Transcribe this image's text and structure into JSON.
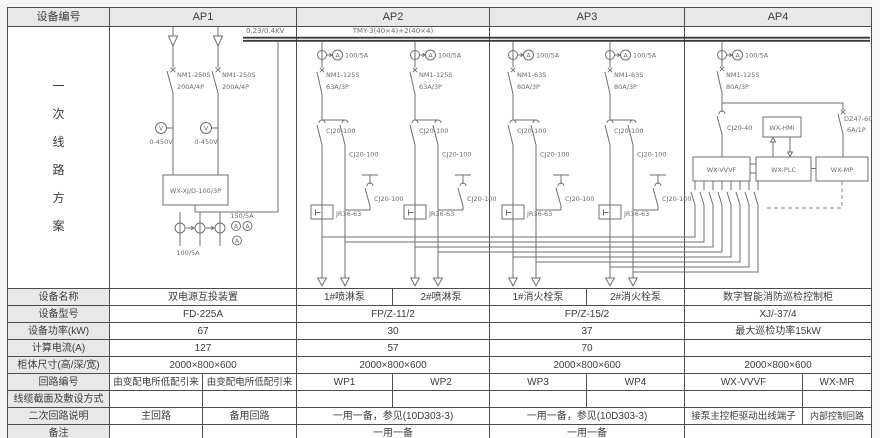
{
  "header": {
    "device_no_label": "设备编号",
    "panels": [
      "AP1",
      "AP2",
      "AP3",
      "AP4"
    ]
  },
  "side": {
    "chars": [
      "一",
      "次",
      "线",
      "路",
      "方",
      "案"
    ]
  },
  "diagram": {
    "busbar_voltage": "0.23/0.4KV",
    "busbar_spec": "TMY-3(40×4)+2(40×4)",
    "meter_v": "V",
    "meter_a": "A",
    "ct100": "100/5A",
    "contactor": "CJ20-100",
    "relay": "JR36-63",
    "ap1": {
      "breaker": "NM1-250S",
      "breaker_rating": "200A/4P",
      "voltmeter_range": "0-450V",
      "ats_box": "WX-XJ/D-100/3P",
      "ct150": "150/5A",
      "ct100": "100/5A"
    },
    "ap2": {
      "breaker": "NM1-125S",
      "breaker_rating": "63A/3P"
    },
    "ap3": {
      "breaker": "NM1-63S",
      "breaker_rating": "80A/3P"
    },
    "ap4": {
      "breaker": "NM1-125S",
      "breaker_rating": "80A/3P",
      "contactor": "CJ20-40",
      "aux_breaker": "DZ47-60",
      "aux_breaker_rating": "6A/1P",
      "hmi_box": "WX-HMI",
      "vvvf_box": "WX-VVVF",
      "plc_box": "WX-PLC",
      "mp_box": "WX-MP"
    }
  },
  "table": {
    "rows": [
      {
        "label": "设备名称",
        "cells": [
          "双电源互投装置",
          "1#喷淋泵",
          "2#喷淋泵",
          "1#消火栓泵",
          "2#消火栓泵",
          "数字智能消防巡检控制柜"
        ]
      },
      {
        "label": "设备型号",
        "cells": [
          "FD-225A",
          "FP/Z-11/2",
          "FP/Z-15/2",
          "XJ/-37/4"
        ]
      },
      {
        "label": "设备功率(kW)",
        "cells": [
          "67",
          "30",
          "37",
          "最大巡检功率15kW"
        ]
      },
      {
        "label": "计算电流(A)",
        "cells": [
          "127",
          "57",
          "70",
          ""
        ]
      },
      {
        "label": "柜体尺寸(高/深/宽)",
        "cells": [
          "2000×800×600",
          "2000×800×600",
          "2000×800×600",
          "2000×800×600"
        ]
      },
      {
        "label": "回路编号",
        "cells": [
          "由变配电所低配引来",
          "由变配电所低配引来",
          "WP1",
          "WP2",
          "WP3",
          "WP4",
          "WX-VVVF",
          "WX-MR"
        ]
      },
      {
        "label": "线缆截面及敷设方式",
        "cells": [
          "",
          "",
          "",
          "",
          "",
          "",
          "",
          ""
        ]
      },
      {
        "label": "二次回路说明",
        "cells": [
          "主回路",
          "备用回路",
          "一用一备，参见(10D303-3)",
          "一用一备，参见(10D303-3)",
          "接泵主控柜驱动出线端子",
          "内部控制回路"
        ]
      },
      {
        "label": "备注",
        "cells": [
          "",
          "",
          "一用一备",
          "一用一备",
          ""
        ]
      }
    ]
  }
}
